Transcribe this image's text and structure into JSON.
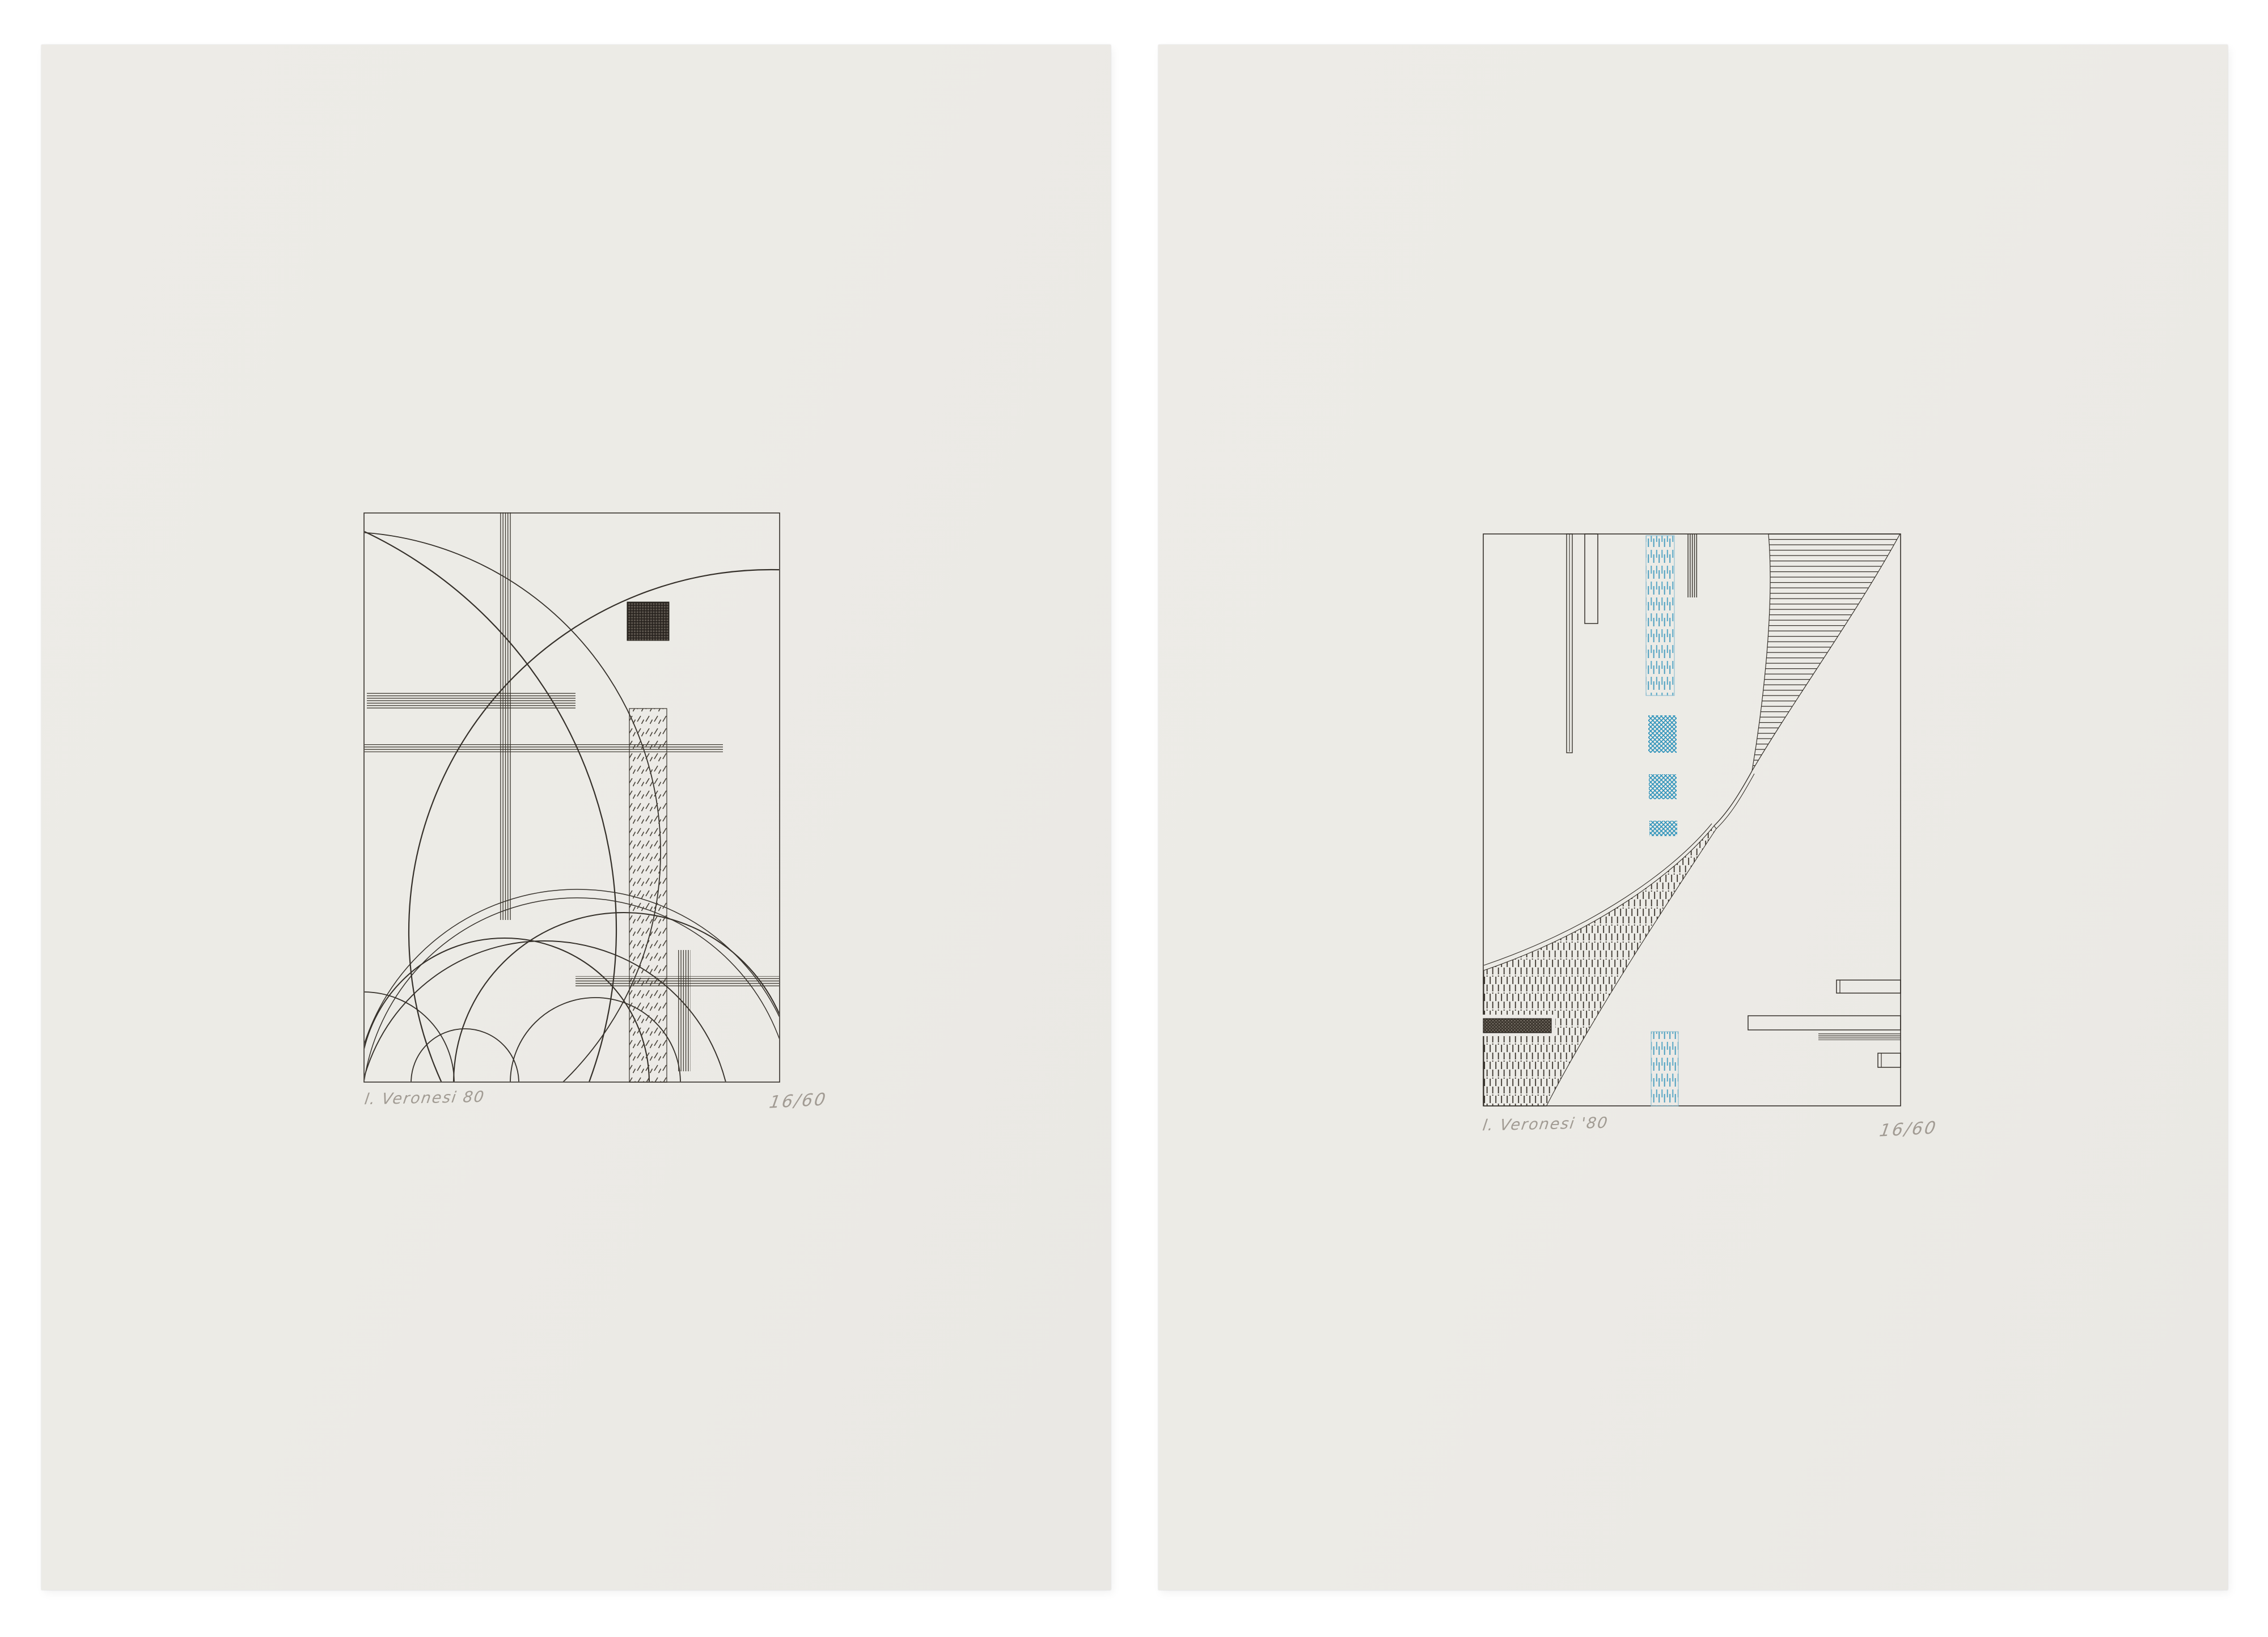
{
  "photo": {
    "description": "two abstract constructivist etchings on cream sheets against white background"
  },
  "colors": {
    "bg": "#ffffff",
    "sheet": "#ebe9e5",
    "ink": "#35302a",
    "ink-soft": "#453f36",
    "blue": "#3e9abe",
    "blue-light": "#58a7c6",
    "pencil": "#a19b93"
  },
  "sheets": {
    "left": {
      "signature": "l. Veronesi 80",
      "edition": "16/60"
    },
    "right": {
      "signature": "l. Veronesi '80",
      "edition": "16/60"
    }
  }
}
